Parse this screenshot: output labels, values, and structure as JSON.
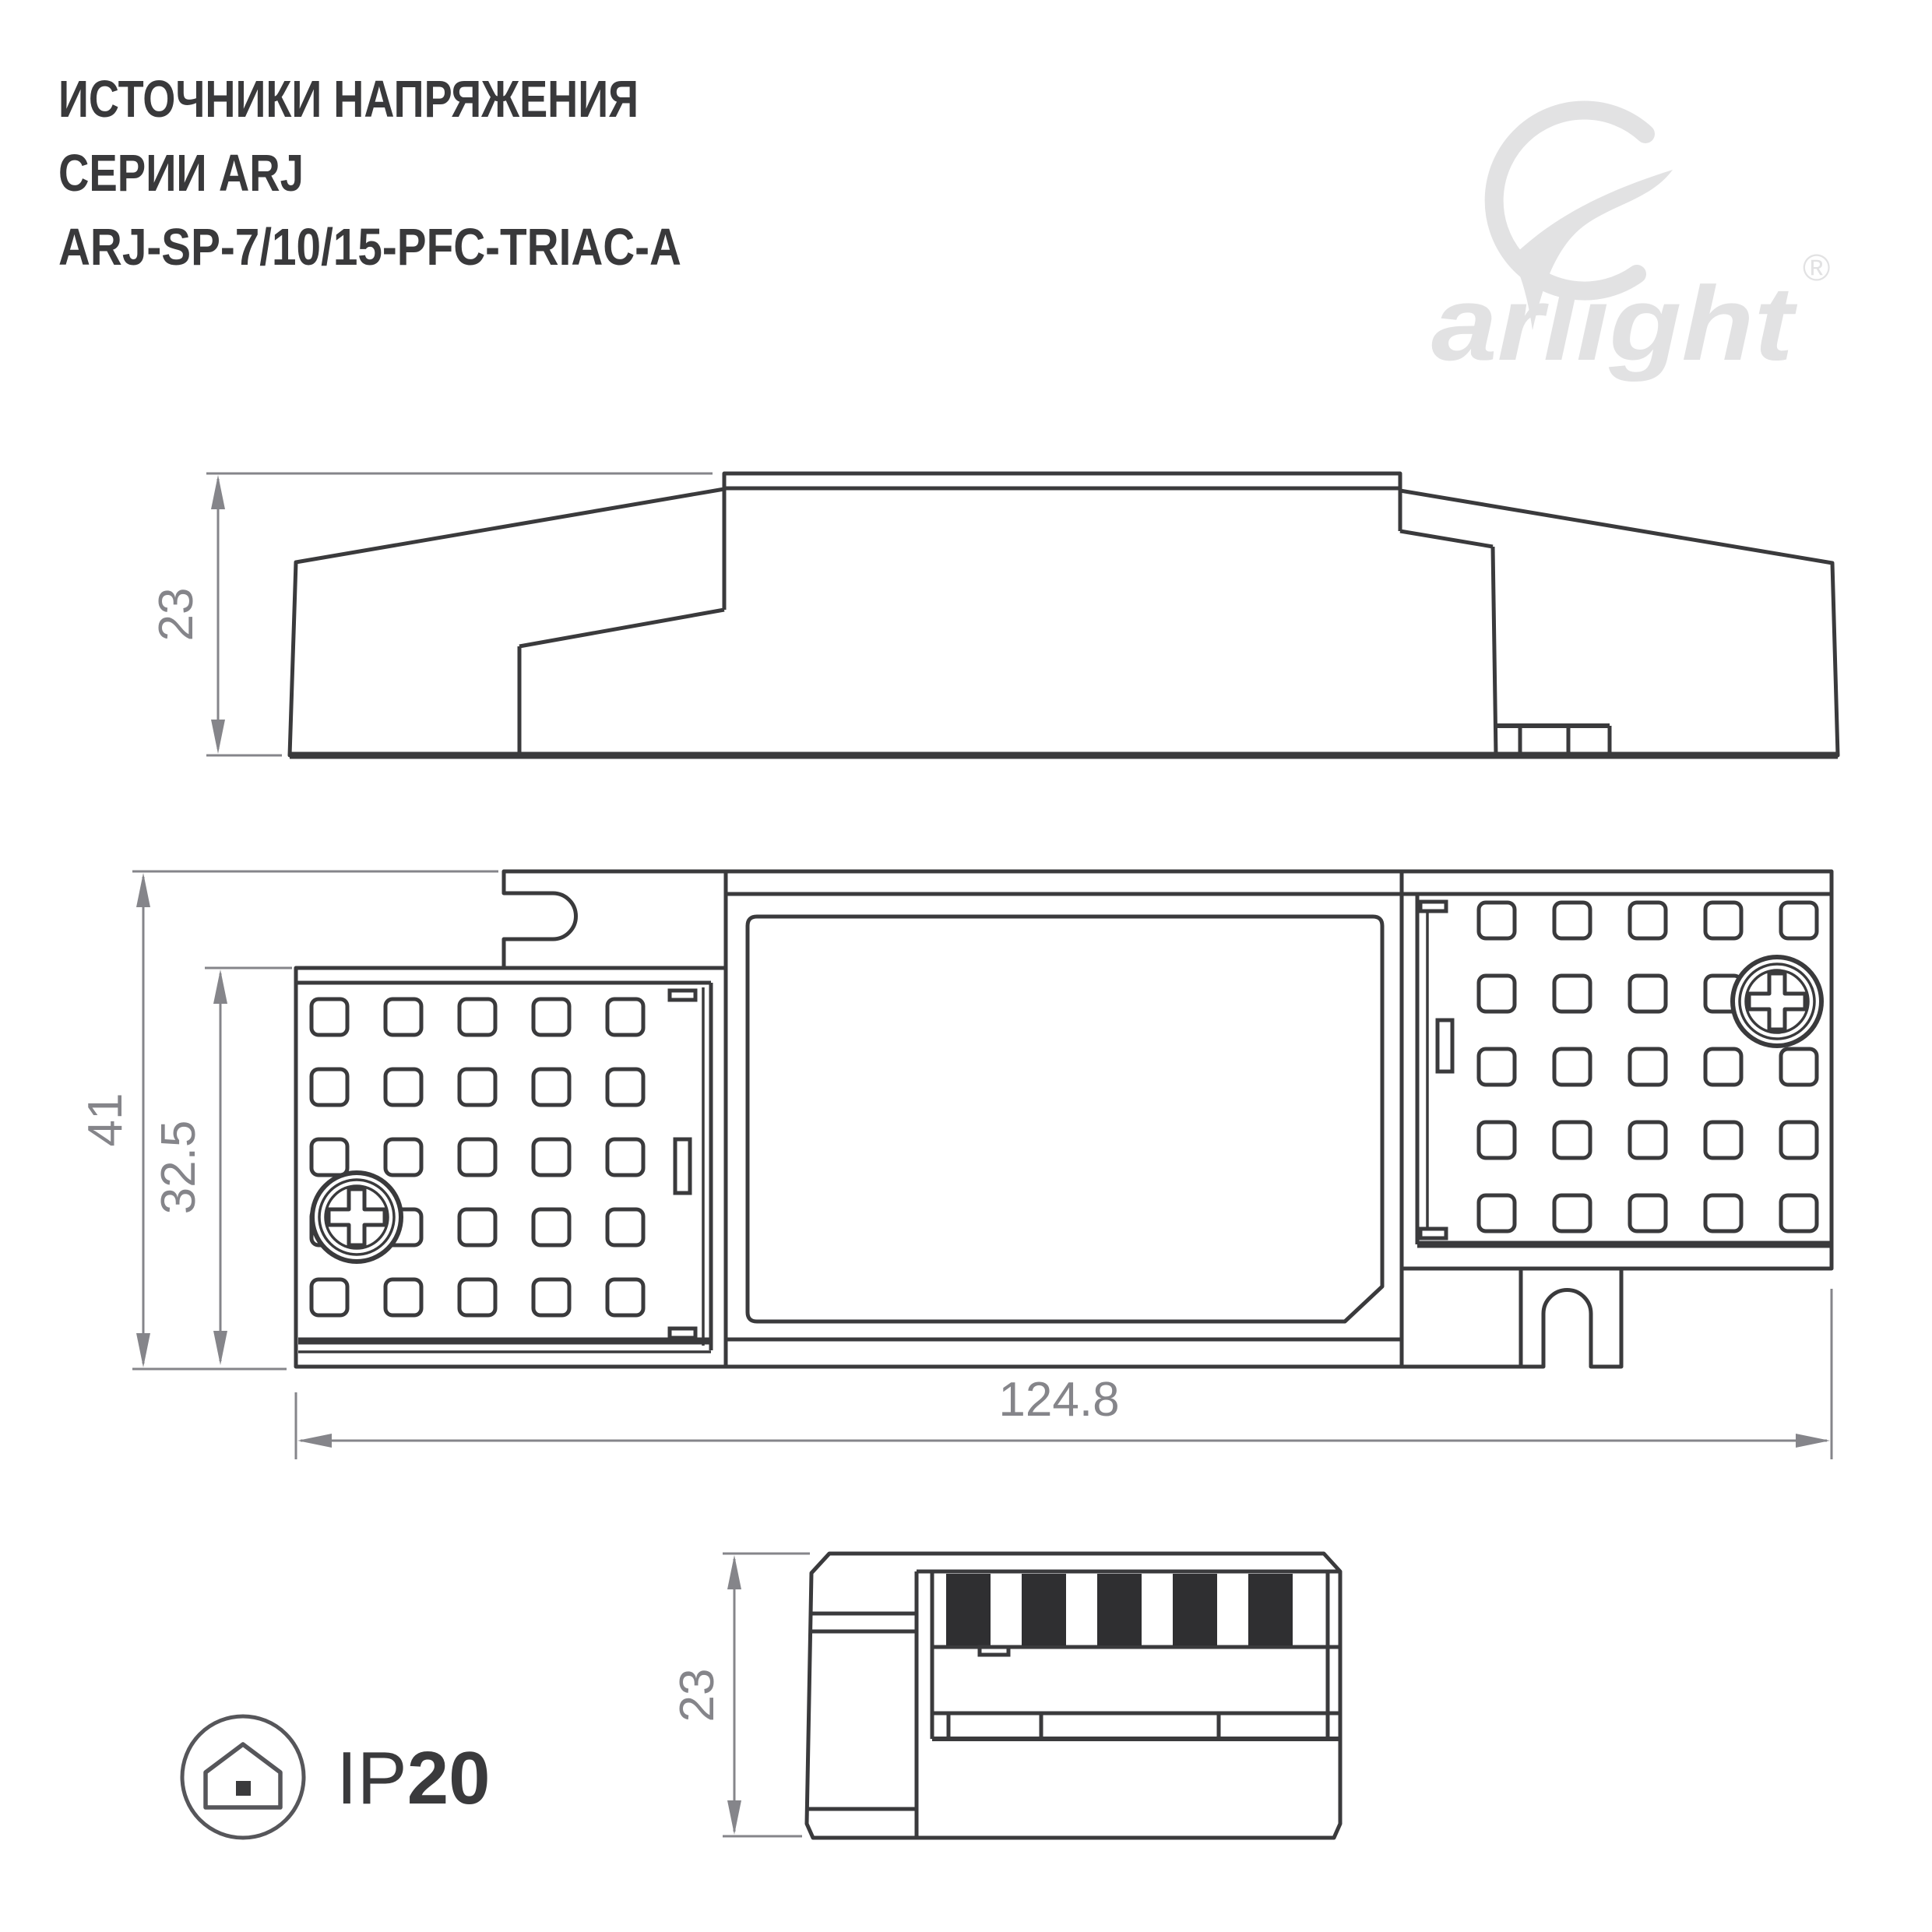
{
  "page": {
    "background": "#ffffff"
  },
  "header": {
    "title_line1": "ИСТОЧНИКИ НАПРЯЖЕНИЯ",
    "title_line2": "СЕРИИ ARJ",
    "title_line3": "ARJ-SP-7/10/15-PFC-TRIAC-A"
  },
  "brand": {
    "logo_icon": "arlight-swoosh-icon",
    "logo_text": "arlight",
    "registered_mark": "®",
    "logo_color": "#e2e2e3"
  },
  "drawing": {
    "line_color": "#3a3a3c",
    "dimension_color": "#85858a",
    "views": {
      "side_view": {
        "height_mm": "23"
      },
      "top_view": {
        "overall_height_mm": "41",
        "cover_height_mm": "32.5",
        "overall_width_mm": "124.8"
      },
      "end_view": {
        "height_mm": "23"
      }
    }
  },
  "protection_badge": {
    "icon": "house-in-circle-icon",
    "prefix": "IP",
    "rating": "20"
  }
}
